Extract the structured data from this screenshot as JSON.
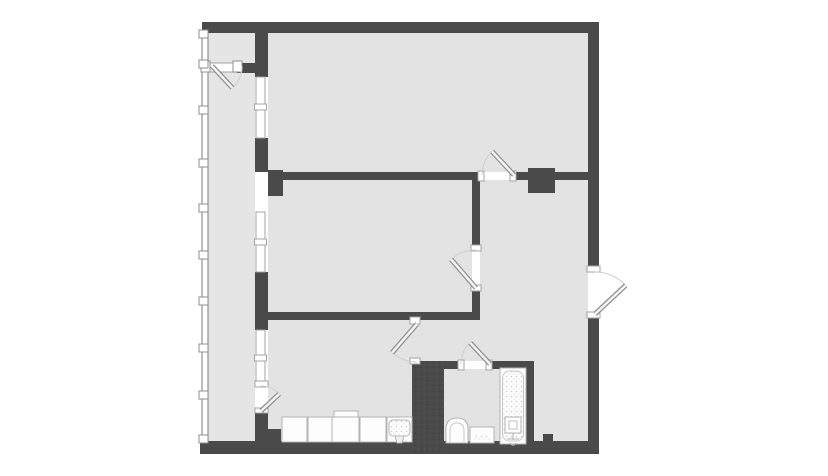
{
  "palette": {
    "wall": "#4a4a4a",
    "floor": "#e3e3e3",
    "floorBalcony": "#e5e5e5",
    "frame": "#a3a3a3",
    "glaze": "#8f8f8f",
    "arc": "#cfcfcf",
    "leafStroke": "#8f8f8f",
    "leafFill": "#f4f4f4",
    "fixStroke": "#b3b3b3",
    "fixFill": "#fdfdfd",
    "white": "#ffffff"
  },
  "plan": {
    "canvas": {
      "width": 828,
      "height": 476
    },
    "layers": [
      {
        "t": "rect",
        "n": "floor-balcony",
        "x": 208,
        "y": 33,
        "w": 47,
        "h": 408,
        "f": "$floorBalcony"
      },
      {
        "t": "rect",
        "n": "floor-top-room",
        "x": 268,
        "y": 33,
        "w": 320,
        "h": 139,
        "f": "$floor"
      },
      {
        "t": "rect",
        "n": "floor-middle-room",
        "x": 268,
        "y": 180,
        "w": 204,
        "h": 132,
        "f": "$floor"
      },
      {
        "t": "rect",
        "n": "floor-living-room",
        "x": 268,
        "y": 320,
        "w": 152,
        "h": 121,
        "f": "$floor"
      },
      {
        "t": "rect",
        "n": "floor-hallway-upper",
        "x": 480,
        "y": 180,
        "w": 108,
        "h": 140,
        "f": "$floor"
      },
      {
        "t": "rect",
        "n": "floor-hallway-mid",
        "x": 415,
        "y": 320,
        "w": 173,
        "h": 41,
        "f": "$floor"
      },
      {
        "t": "rect",
        "n": "floor-hallway-right",
        "x": 534,
        "y": 361,
        "w": 54,
        "h": 80,
        "f": "$floor"
      },
      {
        "t": "rect",
        "n": "floor-bathroom",
        "x": 444,
        "y": 369,
        "w": 82,
        "h": 74,
        "f": "$floor"
      },
      {
        "t": "rect",
        "n": "balcony-glazing",
        "x": 202,
        "y": 33,
        "w": 6,
        "h": 408,
        "f": "$white",
        "s": "$glaze",
        "sw": 1.2
      },
      {
        "t": "rect",
        "n": "top-wall",
        "x": 202,
        "y": 22,
        "w": 396,
        "h": 11,
        "f": "$wall"
      },
      {
        "t": "rect",
        "n": "right-wall-upper",
        "x": 588,
        "y": 22,
        "w": 11,
        "h": 249,
        "f": "$wall"
      },
      {
        "t": "rect",
        "n": "right-wall-lower",
        "x": 588,
        "y": 314,
        "w": 11,
        "h": 140,
        "f": "$wall"
      },
      {
        "t": "rect",
        "n": "bottom-wall",
        "x": 200,
        "y": 441,
        "w": 399,
        "h": 13,
        "f": "$wall"
      },
      {
        "t": "rect",
        "n": "bottom-wall-step",
        "x": 255,
        "y": 429,
        "w": 26,
        "h": 12,
        "f": "$wall"
      },
      {
        "t": "rect",
        "n": "bottom-wall-bump",
        "x": 543,
        "y": 434,
        "w": 10,
        "h": 7,
        "f": "$wall"
      },
      {
        "t": "rect",
        "n": "balcony-sep-wall-a",
        "x": 255,
        "y": 33,
        "w": 13,
        "h": 44,
        "f": "$wall"
      },
      {
        "t": "rect",
        "n": "balcony-sep-wall-b",
        "x": 255,
        "y": 138,
        "w": 13,
        "h": 34,
        "f": "$wall"
      },
      {
        "t": "rect",
        "n": "balcony-sep-wall-c",
        "x": 255,
        "y": 272,
        "w": 13,
        "h": 58,
        "f": "$wall"
      },
      {
        "t": "rect",
        "n": "balcony-sep-wall-d",
        "x": 255,
        "y": 412,
        "w": 13,
        "h": 29,
        "f": "$wall"
      },
      {
        "t": "rect",
        "n": "balcony-partition-wall",
        "x": 237,
        "y": 63,
        "w": 18,
        "h": 10,
        "f": "$wall"
      },
      {
        "t": "rect",
        "n": "midroom-top-wall",
        "x": 268,
        "y": 172,
        "w": 212,
        "h": 8,
        "f": "$wall"
      },
      {
        "t": "rect",
        "n": "midroom-top-stub",
        "x": 268,
        "y": 170,
        "w": 15,
        "h": 26,
        "f": "$wall"
      },
      {
        "t": "rect",
        "n": "midroom-bottom-wall",
        "x": 262,
        "y": 312,
        "w": 218,
        "h": 8,
        "f": "$wall"
      },
      {
        "t": "rect",
        "n": "midroom-right-wall-upper",
        "x": 472,
        "y": 172,
        "w": 8,
        "h": 76,
        "f": "$wall"
      },
      {
        "t": "rect",
        "n": "midroom-right-wall-lower",
        "x": 472,
        "y": 288,
        "w": 8,
        "h": 32,
        "f": "$wall"
      },
      {
        "t": "rect",
        "n": "hall-divider-left",
        "x": 513,
        "y": 172,
        "w": 16,
        "h": 8,
        "f": "$wall"
      },
      {
        "t": "rect",
        "n": "vent-shaft",
        "x": 528,
        "y": 168,
        "w": 27,
        "h": 25,
        "f": "$wall"
      },
      {
        "t": "rect",
        "n": "hall-divider-right",
        "x": 555,
        "y": 172,
        "w": 33,
        "h": 8,
        "f": "$wall"
      },
      {
        "t": "rect",
        "n": "kitchen-bath-wall",
        "x": 412,
        "y": 361,
        "w": 32,
        "h": 93,
        "f": "$wall"
      },
      {
        "t": "rect",
        "n": "kitchen-bath-wall-stipple",
        "x": 412,
        "y": 361,
        "w": 32,
        "h": 93,
        "f": "@walldots"
      },
      {
        "t": "rect",
        "n": "bath-top-wall-left",
        "x": 444,
        "y": 361,
        "w": 17,
        "h": 8,
        "f": "$wall"
      },
      {
        "t": "rect",
        "n": "bath-top-wall-right",
        "x": 489,
        "y": 361,
        "w": 45,
        "h": 8,
        "f": "$wall"
      },
      {
        "t": "rect",
        "n": "bath-right-wall",
        "x": 526,
        "y": 361,
        "w": 8,
        "h": 93,
        "f": "$wall"
      },
      {
        "t": "rect",
        "n": "window-1",
        "x": 256,
        "y": 77,
        "w": 9,
        "h": 61,
        "f": "$white",
        "s": "$frame"
      },
      {
        "t": "rect",
        "n": "window-1-mullion",
        "x": 254.5,
        "y": 104,
        "w": 12,
        "h": 6,
        "f": "$white",
        "s": "$frame"
      },
      {
        "t": "rect",
        "n": "window-2",
        "x": 256,
        "y": 212,
        "w": 9,
        "h": 60,
        "f": "$white",
        "s": "$frame"
      },
      {
        "t": "rect",
        "n": "window-2-mullion",
        "x": 254.5,
        "y": 239,
        "w": 12,
        "h": 6,
        "f": "$white",
        "s": "$frame"
      },
      {
        "t": "rect",
        "n": "window-3",
        "x": 256,
        "y": 330,
        "w": 9,
        "h": 56,
        "f": "$white",
        "s": "$frame"
      },
      {
        "t": "rect",
        "n": "window-3-mullion",
        "x": 254.5,
        "y": 355,
        "w": 12,
        "h": 6,
        "f": "$white",
        "s": "$frame"
      },
      {
        "t": "rect",
        "n": "partition-door-threshold",
        "x": 209,
        "y": 63,
        "w": 26,
        "h": 9,
        "f": "$white",
        "s": "$frame"
      },
      {
        "t": "rect",
        "n": "partition-door-jamb-left",
        "x": 201,
        "y": 61,
        "w": 9,
        "h": 11,
        "f": "$white",
        "s": "$glaze"
      },
      {
        "t": "rect",
        "n": "partition-door-jamb-right",
        "x": 233,
        "y": 61,
        "w": 9,
        "h": 11,
        "f": "$white",
        "s": "$glaze"
      },
      {
        "t": "rect",
        "n": "toproom-door-jamb-left",
        "x": 478,
        "y": 171,
        "w": 6,
        "h": 10,
        "f": "$white",
        "s": "$frame"
      },
      {
        "t": "rect",
        "n": "toproom-door-jamb-right",
        "x": 510,
        "y": 171,
        "w": 6,
        "h": 10,
        "f": "$white",
        "s": "$frame"
      },
      {
        "t": "rect",
        "n": "midroom-door-jamb-top",
        "x": 471,
        "y": 245,
        "w": 10,
        "h": 6,
        "f": "$white",
        "s": "$frame"
      },
      {
        "t": "rect",
        "n": "midroom-door-jamb-bottom",
        "x": 471,
        "y": 285,
        "w": 10,
        "h": 6,
        "f": "$white",
        "s": "$frame"
      },
      {
        "t": "rect",
        "n": "bathroom-door-jamb-left",
        "x": 458,
        "y": 360,
        "w": 6,
        "h": 10,
        "f": "$white",
        "s": "$frame"
      },
      {
        "t": "rect",
        "n": "bathroom-door-jamb-right",
        "x": 486,
        "y": 360,
        "w": 6,
        "h": 10,
        "f": "$white",
        "s": "$frame"
      },
      {
        "t": "rect",
        "n": "living-door-jamb-top",
        "x": 410,
        "y": 317,
        "w": 10,
        "h": 7,
        "f": "$white",
        "s": "$frame"
      },
      {
        "t": "rect",
        "n": "living-door-jamb-bottom",
        "x": 410,
        "y": 358,
        "w": 10,
        "h": 6,
        "f": "$white",
        "s": "$frame"
      },
      {
        "t": "rect",
        "n": "balcony-door-jamb-top",
        "x": 255,
        "y": 381,
        "w": 13,
        "h": 6,
        "f": "$white",
        "s": "$frame"
      },
      {
        "t": "rect",
        "n": "balcony-door-jamb-bottom",
        "x": 255,
        "y": 408,
        "w": 13,
        "h": 5,
        "f": "$white",
        "s": "$frame"
      },
      {
        "t": "rect",
        "n": "entrance-jamb-top",
        "x": 587,
        "y": 266,
        "w": 13,
        "h": 6,
        "f": "$white",
        "s": "$frame"
      },
      {
        "t": "rect",
        "n": "entrance-jamb-bottom",
        "x": 587,
        "y": 312,
        "w": 13,
        "h": 6,
        "f": "$white",
        "s": "$frame"
      },
      {
        "t": "rect",
        "n": "glazing-joint-1",
        "x": 199,
        "y": 30,
        "w": 9,
        "h": 8,
        "f": "$white",
        "s": "$glaze"
      },
      {
        "t": "rect",
        "n": "glazing-joint-2",
        "x": 199,
        "y": 60,
        "w": 9,
        "h": 8,
        "f": "$white",
        "s": "$glaze"
      },
      {
        "t": "rect",
        "n": "glazing-joint-3",
        "x": 199,
        "y": 106,
        "w": 9,
        "h": 8,
        "f": "$white",
        "s": "$glaze"
      },
      {
        "t": "rect",
        "n": "glazing-joint-4",
        "x": 199,
        "y": 159,
        "w": 9,
        "h": 8,
        "f": "$white",
        "s": "$glaze"
      },
      {
        "t": "rect",
        "n": "glazing-joint-5",
        "x": 199,
        "y": 204,
        "w": 9,
        "h": 8,
        "f": "$white",
        "s": "$glaze"
      },
      {
        "t": "rect",
        "n": "glazing-joint-6",
        "x": 199,
        "y": 251,
        "w": 9,
        "h": 8,
        "f": "$white",
        "s": "$glaze"
      },
      {
        "t": "rect",
        "n": "glazing-joint-7",
        "x": 199,
        "y": 297,
        "w": 9,
        "h": 8,
        "f": "$white",
        "s": "$glaze"
      },
      {
        "t": "rect",
        "n": "glazing-joint-8",
        "x": 199,
        "y": 344,
        "w": 9,
        "h": 8,
        "f": "$white",
        "s": "$glaze"
      },
      {
        "t": "rect",
        "n": "glazing-joint-9",
        "x": 199,
        "y": 391,
        "w": 9,
        "h": 8,
        "f": "$white",
        "s": "$glaze"
      },
      {
        "t": "rect",
        "n": "glazing-joint-10",
        "x": 199,
        "y": 435,
        "w": 9,
        "h": 8,
        "f": "$white",
        "s": "$glaze"
      },
      {
        "t": "door",
        "n": "balcony-partition-door",
        "hx": 212,
        "hy": 66,
        "r": 30,
        "closed": 0,
        "leaf": 47
      },
      {
        "t": "door",
        "n": "balcony-living-door",
        "hx": 261,
        "hy": 411,
        "r": 25,
        "closed": 270,
        "leaf": 317
      },
      {
        "t": "door",
        "n": "living-hall-door",
        "hx": 417,
        "hy": 324,
        "r": 38,
        "closed": 90,
        "leaf": 131
      },
      {
        "t": "door",
        "n": "middle-room-door",
        "hx": 476,
        "hy": 288,
        "r": 38,
        "closed": 270,
        "leaf": 229
      },
      {
        "t": "door",
        "n": "top-room-door",
        "hx": 514,
        "hy": 175,
        "r": 32,
        "closed": 180,
        "leaf": 227
      },
      {
        "t": "door",
        "n": "bathroom-door",
        "hx": 490,
        "hy": 364,
        "r": 29,
        "closed": 180,
        "leaf": 227
      },
      {
        "t": "door",
        "n": "entrance-door",
        "hx": 595,
        "hy": 314,
        "r": 42,
        "closed": 270,
        "leaf": 317
      },
      {
        "t": "rect",
        "n": "kitchen-cabinet-1",
        "x": 282,
        "y": 417,
        "w": 25,
        "h": 25,
        "f": "$fixFill",
        "s": "$fixStroke"
      },
      {
        "t": "rect",
        "n": "kitchen-cabinet-2",
        "x": 308,
        "y": 417,
        "w": 24,
        "h": 25,
        "f": "$fixFill",
        "s": "$fixStroke"
      },
      {
        "t": "rect",
        "n": "kitchen-cooktop-lip",
        "x": 334,
        "y": 411,
        "w": 24,
        "h": 6,
        "f": "$fixFill",
        "s": "$fixStroke"
      },
      {
        "t": "rect",
        "n": "kitchen-cooktop",
        "x": 332,
        "y": 417,
        "w": 27,
        "h": 25,
        "f": "$fixFill",
        "s": "$fixStroke"
      },
      {
        "t": "rect",
        "n": "kitchen-cabinet-3",
        "x": 360,
        "y": 417,
        "w": 26,
        "h": 25,
        "f": "$fixFill",
        "s": "$fixStroke"
      },
      {
        "t": "rect",
        "n": "kitchen-sink-unit",
        "x": 387,
        "y": 417,
        "w": 25,
        "h": 25,
        "f": "$fixFill",
        "s": "$fixStroke"
      },
      {
        "t": "rect",
        "n": "kitchen-sink-basin",
        "x": 389,
        "y": 420,
        "w": 21,
        "h": 16,
        "rx": 4,
        "f": "@dots",
        "s": "$fixStroke"
      },
      {
        "t": "path",
        "n": "kitchen-sink-faucet",
        "d": "M395,436 L404,436 L402,443 L397,443 Z",
        "f": "#f0f0f0",
        "s": "$fixStroke"
      },
      {
        "t": "path",
        "n": "toilet",
        "d": "M446,443 L446,429 Q446,418 457,418 Q468,418 468,429 L468,443 Z",
        "f": "$fixFill",
        "s": "$fixStroke"
      },
      {
        "t": "path",
        "n": "toilet-rim",
        "d": "M450,443 L450,431 Q450,423 457,423 Q464,423 464,431 L464,443",
        "f": "none",
        "s": "#c9c9c9"
      },
      {
        "t": "rect",
        "n": "bathroom-vanity",
        "x": 470,
        "y": 427,
        "w": 24,
        "h": 16,
        "f": "$fixFill",
        "s": "$fixStroke"
      },
      {
        "t": "rect",
        "n": "bathroom-vanity-grate",
        "x": 474,
        "y": 435,
        "w": 16,
        "h": 6,
        "f": "@dots"
      },
      {
        "t": "rect",
        "n": "bathtub",
        "x": 500,
        "y": 368,
        "w": 26,
        "h": 76,
        "f": "$fixFill",
        "s": "$fixStroke"
      },
      {
        "t": "rect",
        "n": "bathtub-basin",
        "x": 502.5,
        "y": 371,
        "w": 21,
        "h": 70,
        "rx": 7,
        "f": "@dots",
        "s": "#c6c6c6"
      },
      {
        "t": "rect",
        "n": "bathtub-mixer",
        "x": 505,
        "y": 417,
        "w": 16,
        "h": 16,
        "f": "$fixFill",
        "s": "$fixStroke"
      },
      {
        "t": "rect",
        "n": "bathtub-mixer-inner",
        "x": 509,
        "y": 421,
        "w": 8,
        "h": 8,
        "f": "$white",
        "s": "#c0c0c0"
      },
      {
        "t": "path",
        "n": "bathtub-tap",
        "d": "M513,433 L513,440 M507,439 L519,439 M510,443 C512,446 514,446 516,443",
        "f": "none",
        "s": "$fixStroke"
      }
    ]
  }
}
